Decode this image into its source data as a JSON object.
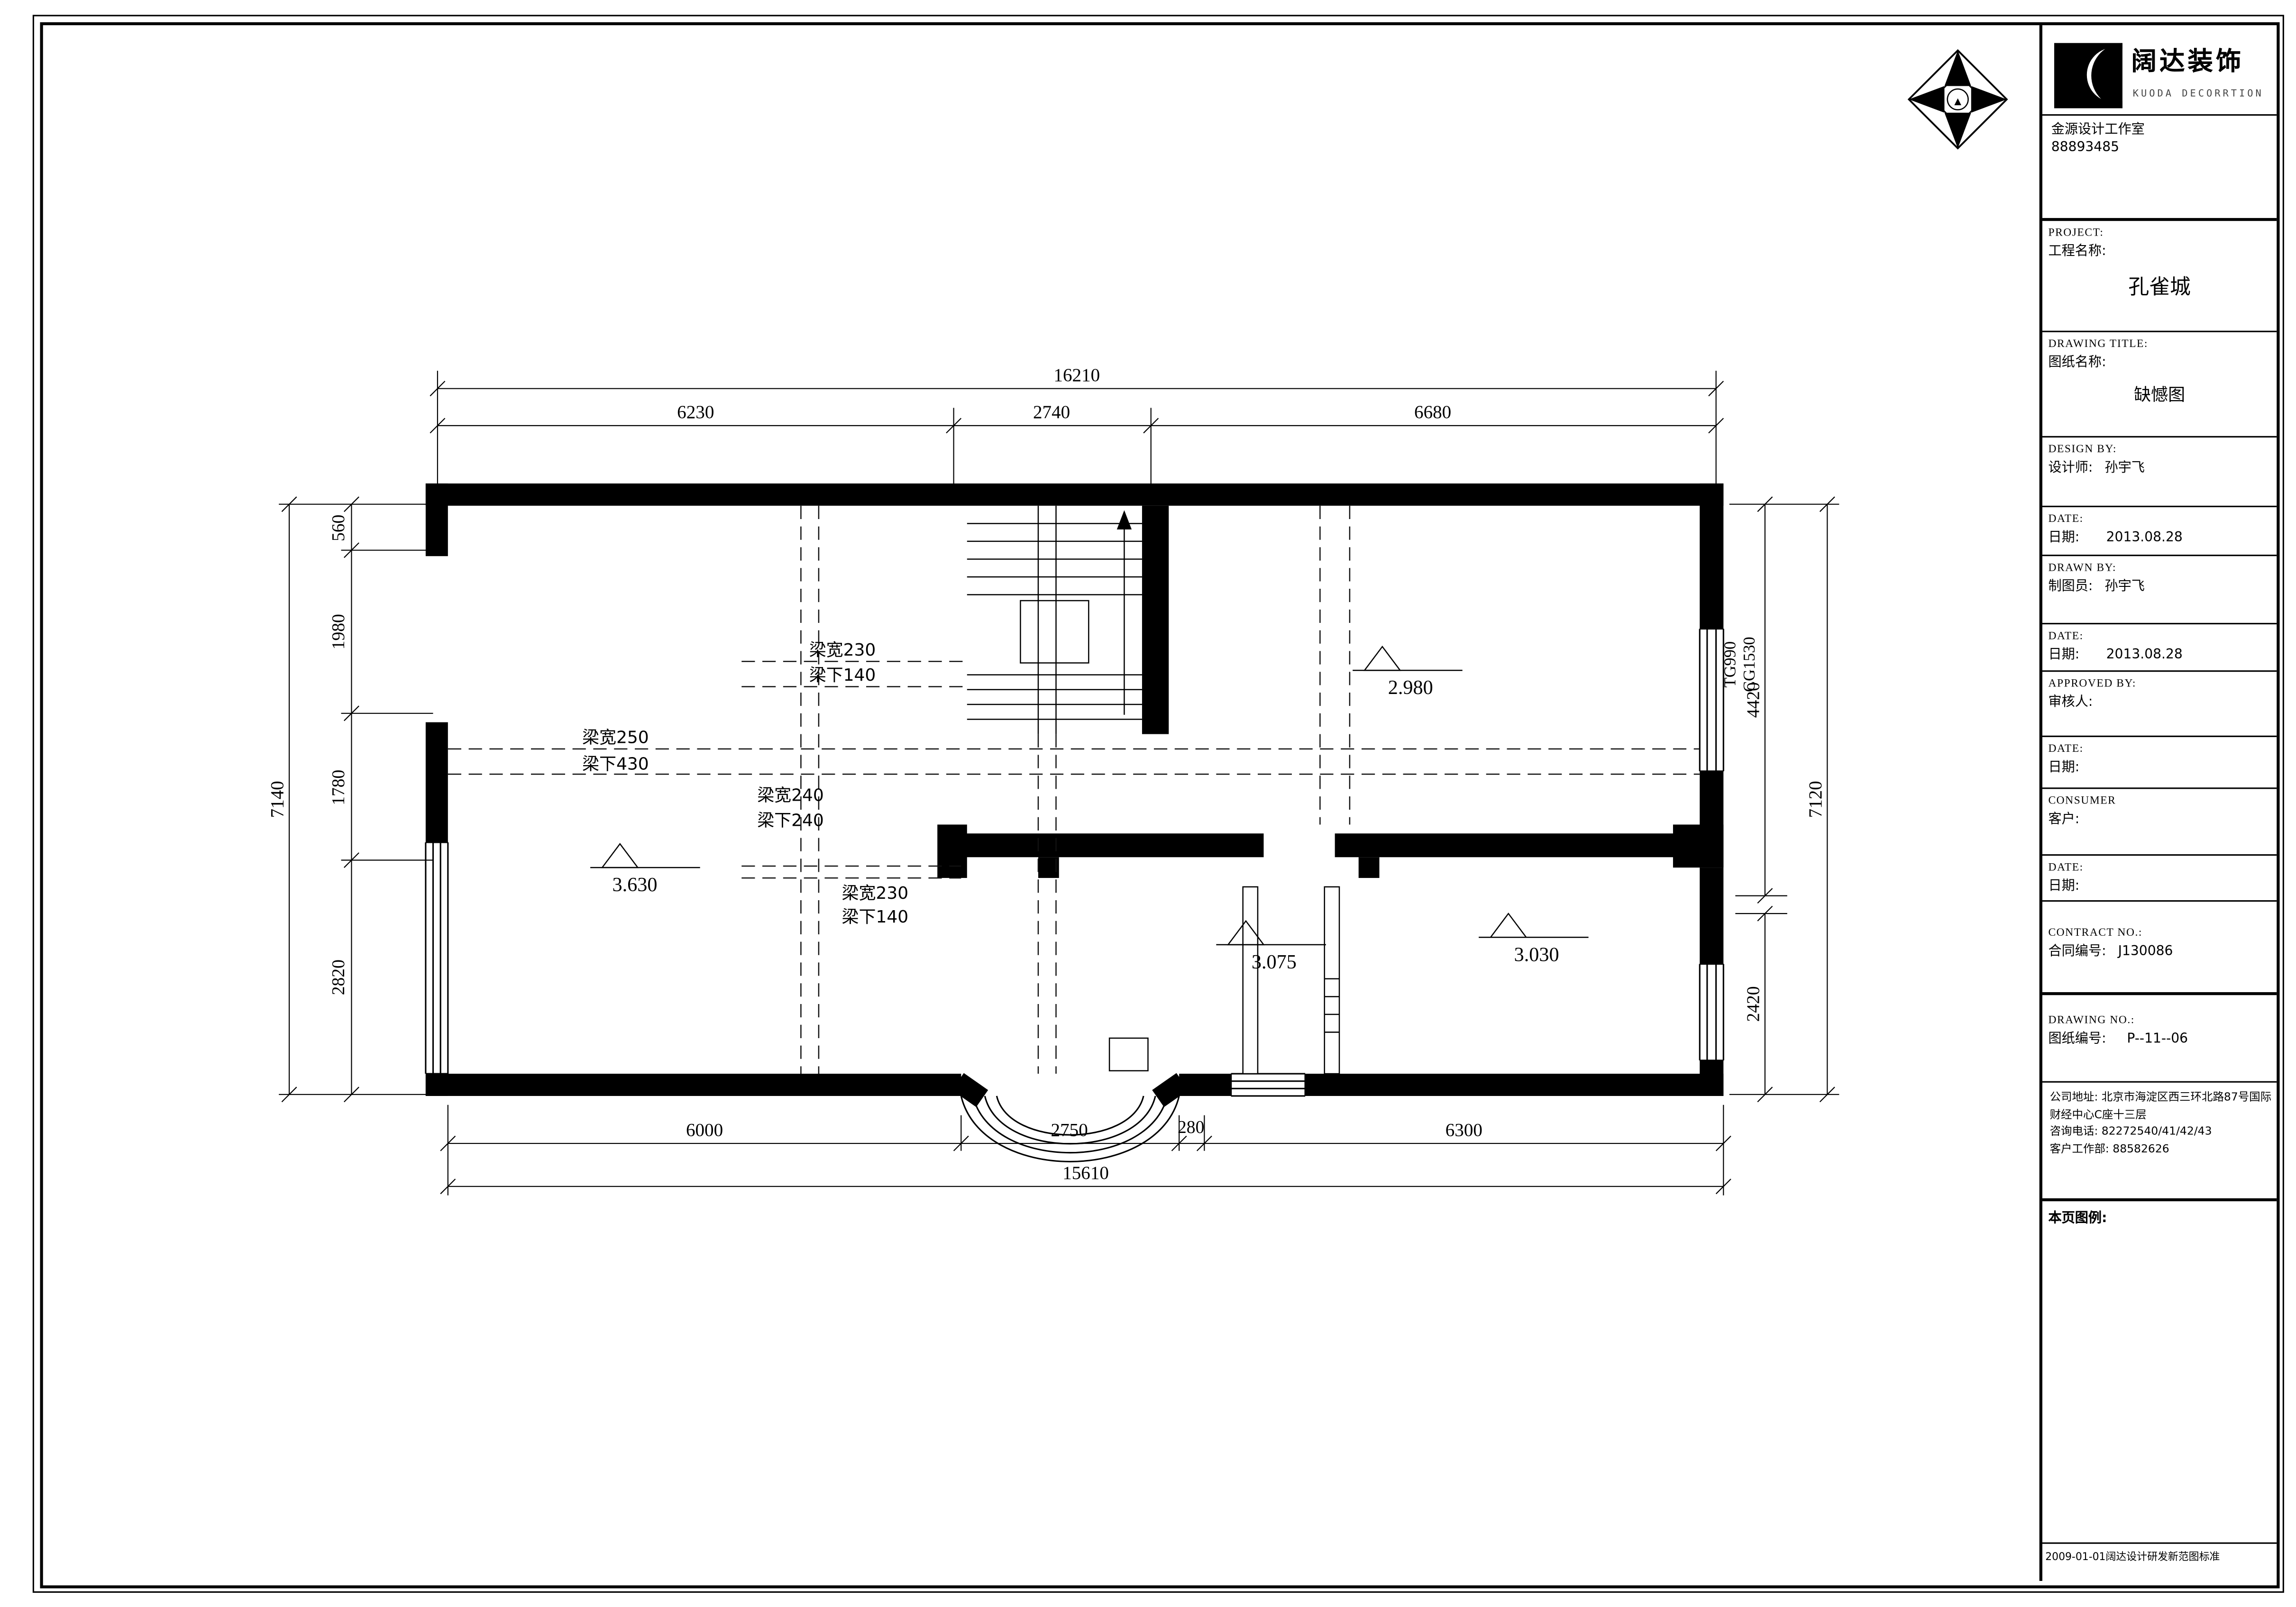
{
  "title_block": {
    "logo": {
      "cn": "阔达装饰",
      "en": "KUODA DECORRTION"
    },
    "studio": {
      "name": "金源设计工作室",
      "phone": "88893485"
    },
    "fields": [
      {
        "en": "PROJECT:",
        "cn": "工程名称:",
        "value": "孔雀城"
      },
      {
        "en": "DRAWING TITLE:",
        "cn": "图纸名称:",
        "value": "缺憾图"
      },
      {
        "en": "DESIGN BY:",
        "cn": "设计师:",
        "value": "孙宇飞"
      },
      {
        "en": "DATE:",
        "cn": "日期:",
        "value": "2013.08.28"
      },
      {
        "en": "DRAWN BY:",
        "cn": "制图员:",
        "value": "孙宇飞"
      },
      {
        "en": "DATE:",
        "cn": "日期:",
        "value": "2013.08.28"
      },
      {
        "en": "APPROVED BY:",
        "cn": "审核人:",
        "value": ""
      },
      {
        "en": "DATE:",
        "cn": "日期:",
        "value": ""
      },
      {
        "en": "CONSUMER",
        "cn": "客户:",
        "value": ""
      },
      {
        "en": "DATE:",
        "cn": "日期:",
        "value": ""
      },
      {
        "en": "CONTRACT NO.:",
        "cn": "合同编号:",
        "value": "J130086"
      },
      {
        "en": "DRAWING NO.:",
        "cn": "图纸编号:",
        "value": "P--11--06"
      }
    ],
    "address_lines": [
      "公司地址: 北京市海淀区西三环北路87号国际",
      "财经中心C座十三层",
      "咨询电话: 82272540/41/42/43",
      "客户工作部: 88582626"
    ],
    "legend_label": "本页图例:",
    "standard_note": "2009-01-01阔达设计研发新范图标准"
  },
  "north_arrow": {
    "glyph": "▲"
  },
  "plan": {
    "dimensions": {
      "top": {
        "overall": "16210",
        "segments": [
          "6230",
          "2740",
          "6680"
        ]
      },
      "bottom": {
        "overall": "15610",
        "segments": [
          "6000",
          "2750",
          "280",
          "6300"
        ]
      },
      "left": {
        "overall": "7140",
        "segments": [
          "560",
          "1980",
          "1780",
          "2820"
        ]
      },
      "right": {
        "overall": "7120",
        "segments": [
          "4420",
          "2420"
        ]
      }
    },
    "window_tag": {
      "line1": "TG990",
      "line2": "CG1530"
    },
    "beam_labels": [
      {
        "line1": "梁宽230",
        "line2": "梁下140"
      },
      {
        "line1": "梁宽250",
        "line2": "梁下430"
      },
      {
        "line1": "梁宽240",
        "line2": "梁下240"
      },
      {
        "line1": "梁宽230",
        "line2": "梁下140"
      }
    ],
    "levels": [
      "3.630",
      "2.980",
      "3.075",
      "3.030"
    ]
  }
}
